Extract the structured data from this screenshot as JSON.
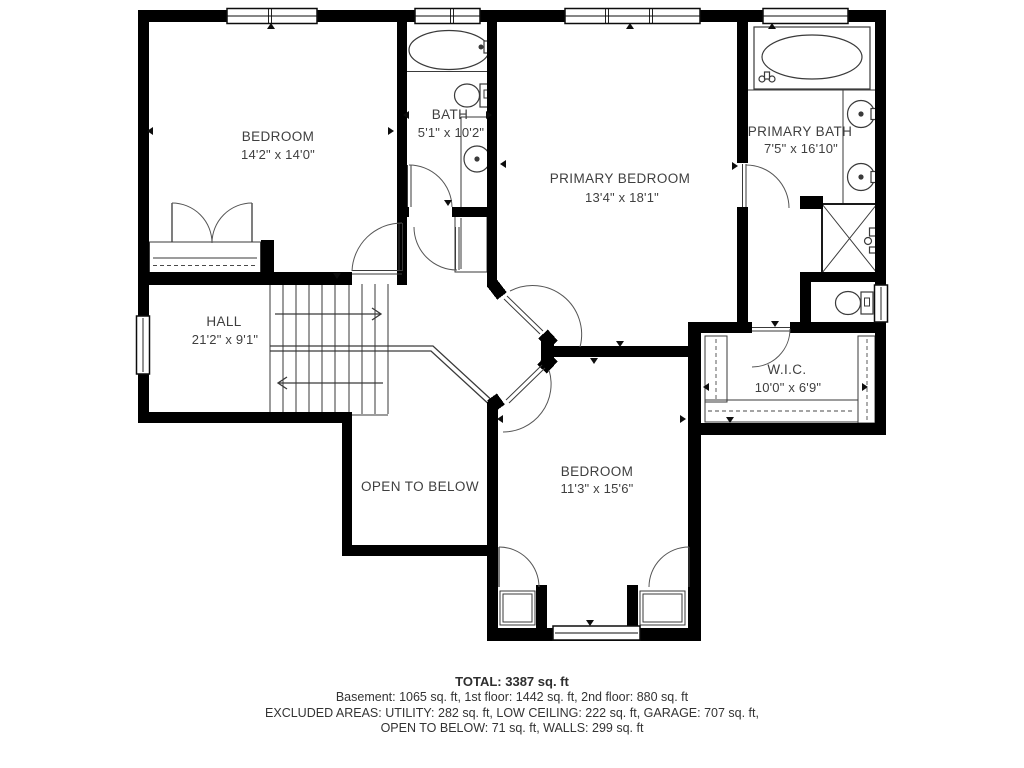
{
  "plan": {
    "title": "Second floor plan",
    "rooms": {
      "bedroom1": {
        "name": "BEDROOM",
        "dims": "14'2\" x 14'0\""
      },
      "bath": {
        "name": "BATH",
        "dims": "5'1\" x 10'2\""
      },
      "primary_bedroom": {
        "name": "PRIMARY BEDROOM",
        "dims": "13'4\" x 18'1\""
      },
      "primary_bath": {
        "name": "PRIMARY BATH",
        "dims": "7'5\" x 16'10\""
      },
      "hall": {
        "name": "HALL",
        "dims": "21'2\" x 9'1\""
      },
      "wic": {
        "name": "W.I.C.",
        "dims": "10'0\" x 6'9\""
      },
      "bedroom2": {
        "name": "BEDROOM",
        "dims": "11'3\" x 15'6\""
      },
      "open_to_below": {
        "name": "OPEN TO BELOW"
      }
    },
    "summary": {
      "total": "TOTAL: 3387 sq. ft",
      "floors": "Basement: 1065 sq. ft, 1st floor: 1442 sq. ft, 2nd floor: 880 sq. ft",
      "excluded": "EXCLUDED AREAS: UTILITY: 282 sq. ft, LOW CEILING: 222 sq. ft, GARAGE: 707 sq. ft,",
      "excluded2": "OPEN TO BELOW: 71 sq. ft, WALLS: 299 sq. ft"
    },
    "colors": {
      "wall": "#000000",
      "text": "#3f3f3f",
      "background": "#ffffff"
    }
  }
}
